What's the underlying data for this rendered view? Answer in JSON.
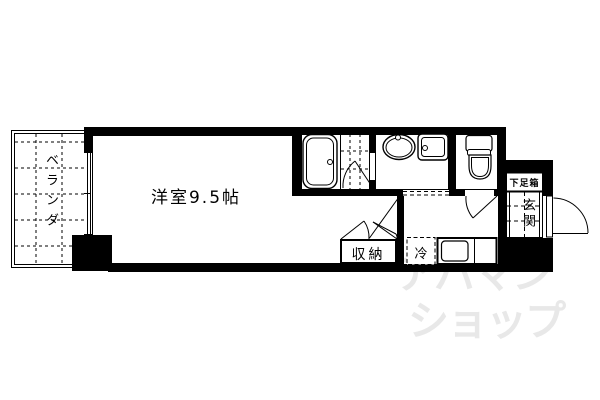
{
  "plan": {
    "main_room_label": "洋室9.5帖",
    "veranda_label": "ベランダ",
    "closet_label": "収納",
    "fridge_label": "冷",
    "entrance_label": "玄関",
    "shoe_box_label": "下足箱"
  },
  "fixtures": {
    "icons": [
      "bathtub-icon",
      "washbasin-icon",
      "washing-machine-pan-icon",
      "toilet-icon",
      "kitchen-sink-icon",
      "door-swing-icon",
      "window-icon"
    ]
  },
  "watermark": {
    "line1": "アパマン",
    "line2": "ショップ",
    "color": "#e8e8e8"
  },
  "colors": {
    "line": "#000000",
    "background": "#ffffff"
  }
}
